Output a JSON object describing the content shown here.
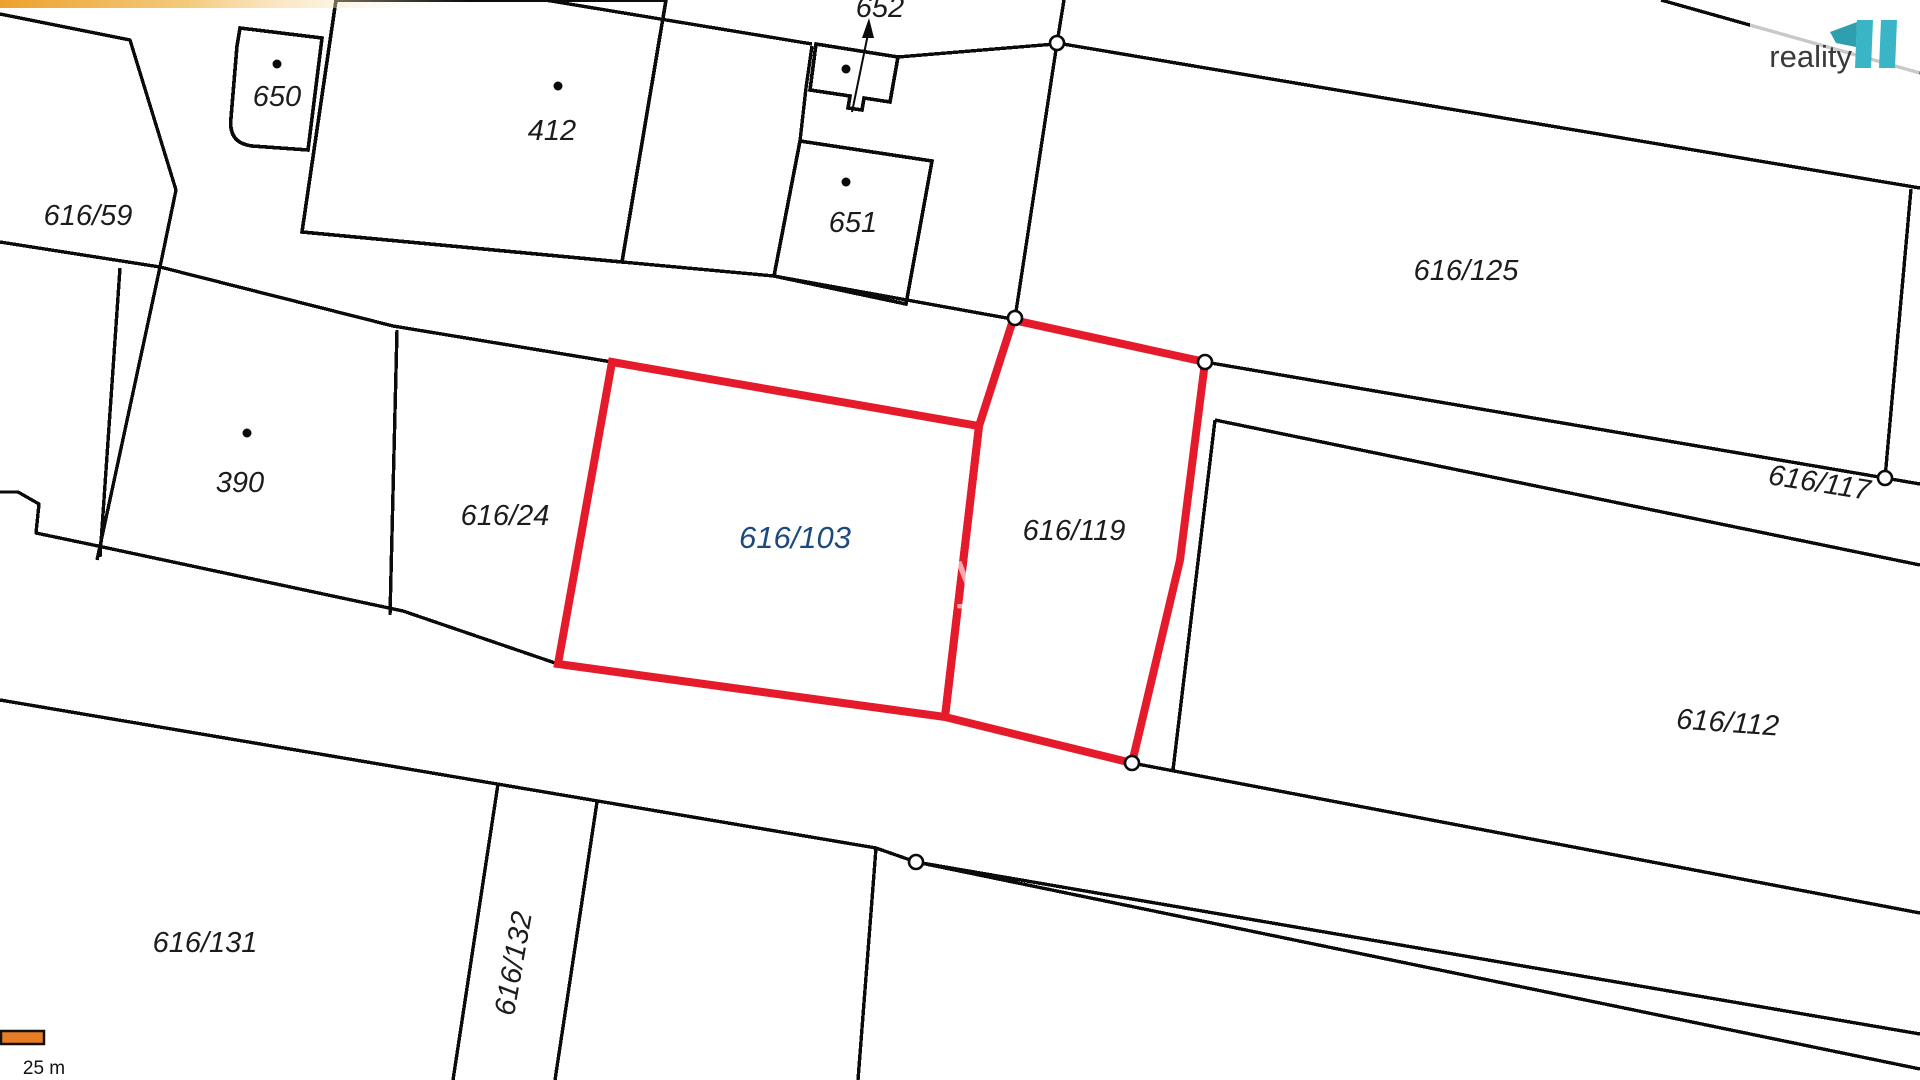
{
  "map_type": "cadastral-parcel-map",
  "labels": [
    {
      "id": "652",
      "text": "652"
    },
    {
      "id": "650",
      "text": "650"
    },
    {
      "id": "412",
      "text": "412"
    },
    {
      "id": "651",
      "text": "651"
    },
    {
      "id": "616-59",
      "text": "616/59"
    },
    {
      "id": "616-125",
      "text": "616/125"
    },
    {
      "id": "390",
      "text": "390"
    },
    {
      "id": "616-24",
      "text": "616/24"
    },
    {
      "id": "616-103",
      "text": "616/103"
    },
    {
      "id": "616-119",
      "text": "616/119"
    },
    {
      "id": "616-117",
      "text": "616/117"
    },
    {
      "id": "616-112",
      "text": "616/112"
    },
    {
      "id": "616-131",
      "text": "616/131"
    },
    {
      "id": "616-132",
      "text": "616/132"
    }
  ],
  "highlighted_parcel": {
    "number": "616/103",
    "fill": "#B9DDF9",
    "outline": "#E51A2B"
  },
  "outlined_parcel": {
    "number": "616/119",
    "outline": "#E51A2B"
  },
  "watermark": {
    "text": "reality"
  },
  "logo": {
    "text": "reality",
    "mark": "11"
  },
  "scale_bar": {
    "label": "25 m"
  },
  "colors": {
    "boundary": "#0B0B0B",
    "highlight_fill": "#B9DDF9",
    "highlight_outline": "#E51A2B",
    "parcel_number_blue": "#1B4A7E",
    "logo_teal": "#3AB5C5",
    "scale_orange": "#E87C25",
    "banner_orange": "#EDA12B"
  }
}
